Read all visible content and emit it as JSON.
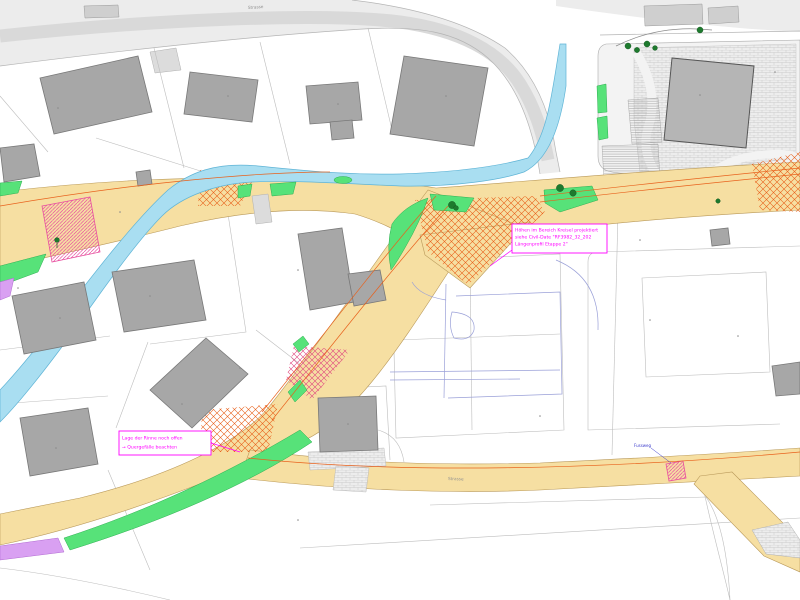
{
  "annotations": {
    "note_kreisel": {
      "lines": [
        "Höhen im Bereich Kreisel projektiert",
        "siehe Civil-Date \"RF3982_32_202",
        "Längenprofil Etappe 2\""
      ]
    },
    "note_rinne": {
      "lines": [
        "Lage der Rinne noch offen",
        "→  Quergefälle beachten"
      ]
    },
    "footpath_label": "Fussweg"
  },
  "street_labels": {
    "top": "Strasse",
    "bottom": "Strasse"
  },
  "legend_colors": {
    "road_surface": "#f6dfa2",
    "existing_road": "#ececec",
    "building": "#a7a7a7",
    "water_channel": "#a9def1",
    "green_area": "#57e279",
    "violet_area": "#d9a0f2",
    "construction_hatch": "#e8611c",
    "crossing_hatch": "#e84fa0",
    "annotation": "#ff00ff"
  }
}
